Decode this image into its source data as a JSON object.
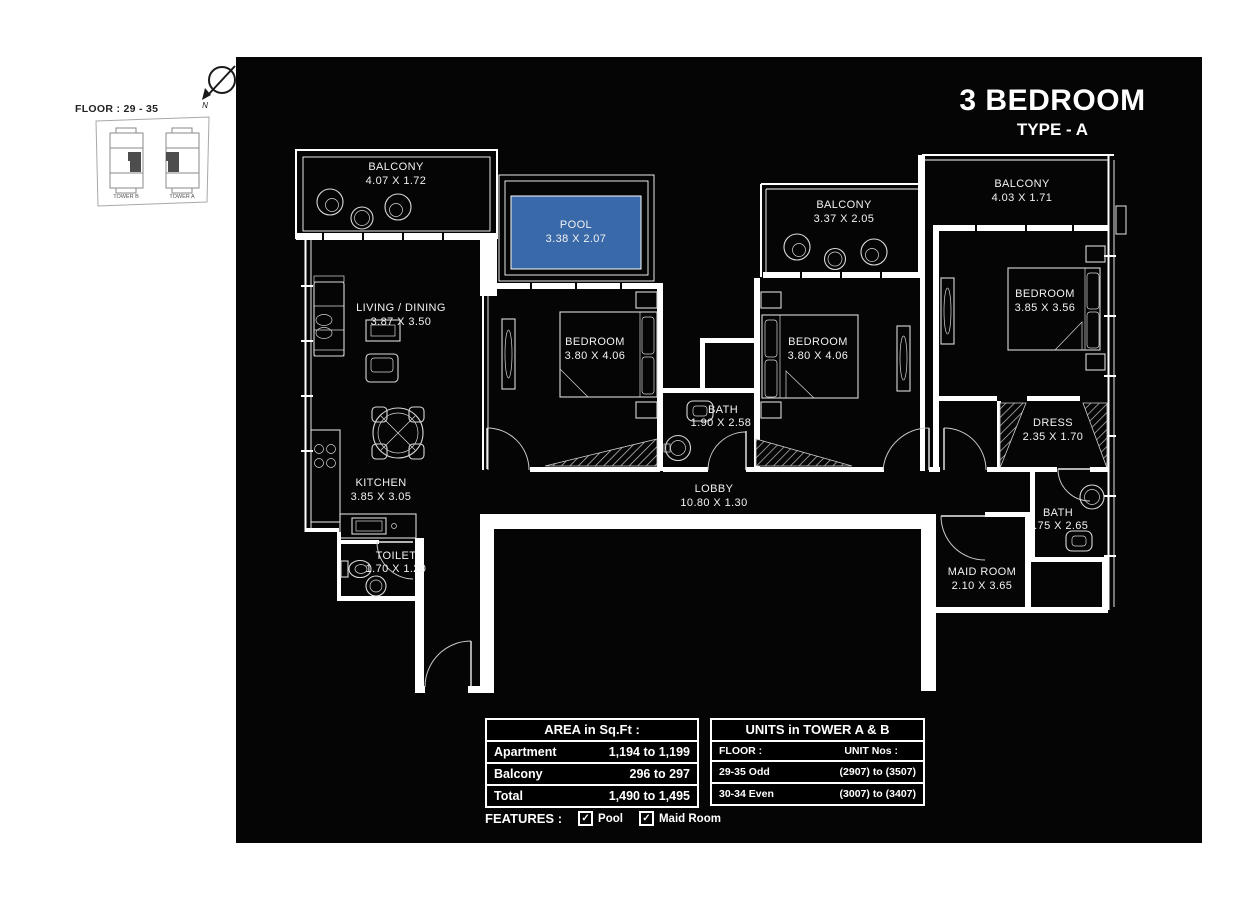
{
  "header": {
    "title": "3 BEDROOM",
    "subtitle": "TYPE - A"
  },
  "key_plan": {
    "floor_label": "FLOOR : 29 - 35",
    "tower_b": "TOWER B",
    "tower_a": "TOWER A",
    "north_label": "N"
  },
  "rooms": {
    "balcony_left": {
      "name": "BALCONY",
      "dims": "4.07 X 1.72"
    },
    "pool": {
      "name": "POOL",
      "dims": "3.38 X 2.07"
    },
    "balcony_mid": {
      "name": "BALCONY",
      "dims": "3.37 X 2.05"
    },
    "balcony_right": {
      "name": "BALCONY",
      "dims": "4.03 X 1.71"
    },
    "living": {
      "name": "LIVING / DINING",
      "dims": "3.87 X 3.50"
    },
    "bedroom1": {
      "name": "BEDROOM",
      "dims": "3.80 X 4.06"
    },
    "bedroom2": {
      "name": "BEDROOM",
      "dims": "3.80 X 4.06"
    },
    "bedroom3": {
      "name": "BEDROOM",
      "dims": "3.85 X 3.56"
    },
    "bath1": {
      "name": "BATH",
      "dims": "1.90 X 2.58"
    },
    "kitchen": {
      "name": "KITCHEN",
      "dims": "3.85 X 3.05"
    },
    "lobby": {
      "name": "LOBBY",
      "dims": "10.80 X 1.30"
    },
    "toilet": {
      "name": "TOILET",
      "dims": "1.70 X 1.20"
    },
    "dress": {
      "name": "DRESS",
      "dims": "2.35 X 1.70"
    },
    "bath2": {
      "name": "BATH",
      "dims": "1.75 X 2.65"
    },
    "maid": {
      "name": "MAID ROOM",
      "dims": "2.10 X 3.65"
    }
  },
  "area_table": {
    "header": "AREA in Sq.Ft :",
    "rows": [
      {
        "label": "Apartment",
        "value": "1,194 to 1,199"
      },
      {
        "label": "Balcony",
        "value": "296 to 297"
      },
      {
        "label": "Total",
        "value": "1,490 to 1,495"
      }
    ]
  },
  "units_table": {
    "header": "UNITS in TOWER A & B",
    "col_floor": "FLOOR :",
    "col_units": "UNIT Nos :",
    "rows": [
      {
        "floor": "29-35 Odd",
        "units": "(2907) to (3507)"
      },
      {
        "floor": "30-34 Even",
        "units": "(3007) to (3407)"
      }
    ]
  },
  "features": {
    "label": "FEATURES :",
    "check_glyph": "✓",
    "items": [
      "Pool",
      "Maid Room"
    ]
  },
  "colors": {
    "pool_fill": "#3a69a9",
    "canvas": "#050505"
  }
}
